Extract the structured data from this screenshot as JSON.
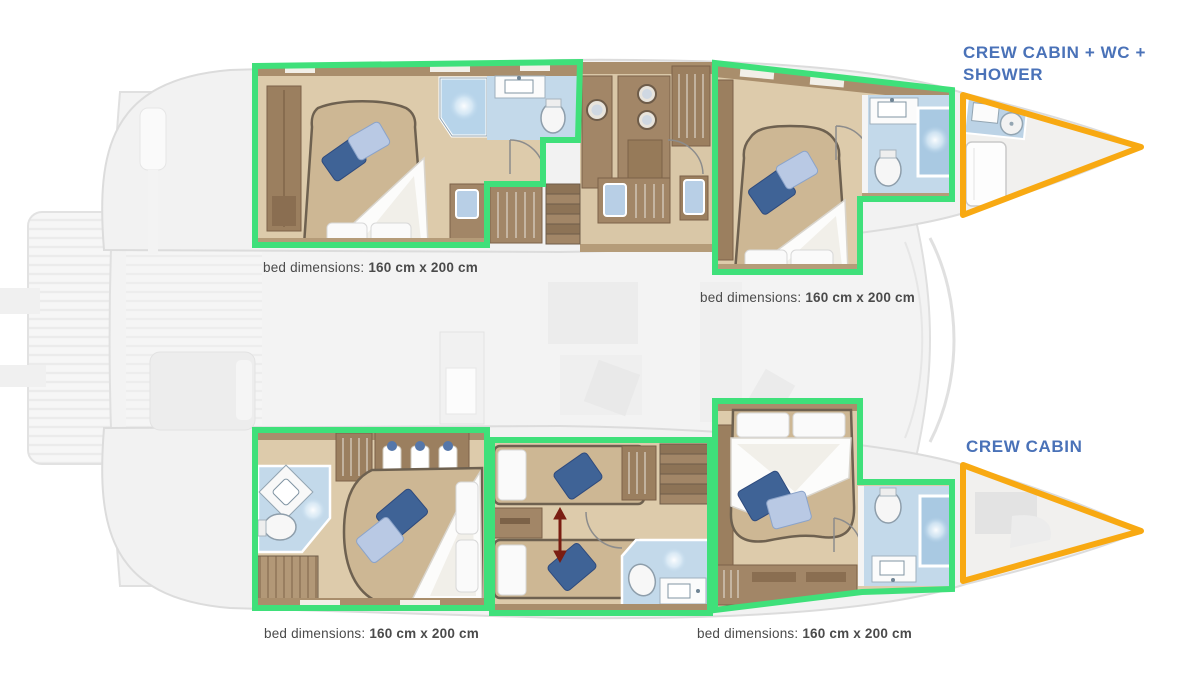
{
  "annotations": {
    "crew_cabin_top_label": "CREW CABIN + WC + SHOWER",
    "crew_cabin_bottom_label": "CREW CABIN"
  },
  "bed_captions": [
    {
      "prefix": "bed dimensions:",
      "value": "160 cm x 200 cm"
    },
    {
      "prefix": "bed dimensions:",
      "value": "160 cm x 200 cm"
    },
    {
      "prefix": "bed dimensions:",
      "value": "160 cm x 200 cm"
    },
    {
      "prefix": "bed dimensions:",
      "value": "160 cm x 200 cm"
    }
  ],
  "legend": {
    "guest_cabin_outline_color": "#3fe07a",
    "crew_cabin_outline_color": "#f8a912",
    "label_text_color": "#4a72b8",
    "caption_text_color": "#4a4a4a"
  },
  "icons": {
    "shower-icon": "radial-glow-square",
    "toilet-icon": "ellipse-bowl",
    "sink-icon": "counter-basin",
    "bed-icon": "mattress-with-pillows",
    "wardrobe-icon": "hanger-lines",
    "washer-icon": "porthole-circle",
    "stairs-icon": "step-strips",
    "convertible-arrow-icon": "double-headed-arrow"
  }
}
